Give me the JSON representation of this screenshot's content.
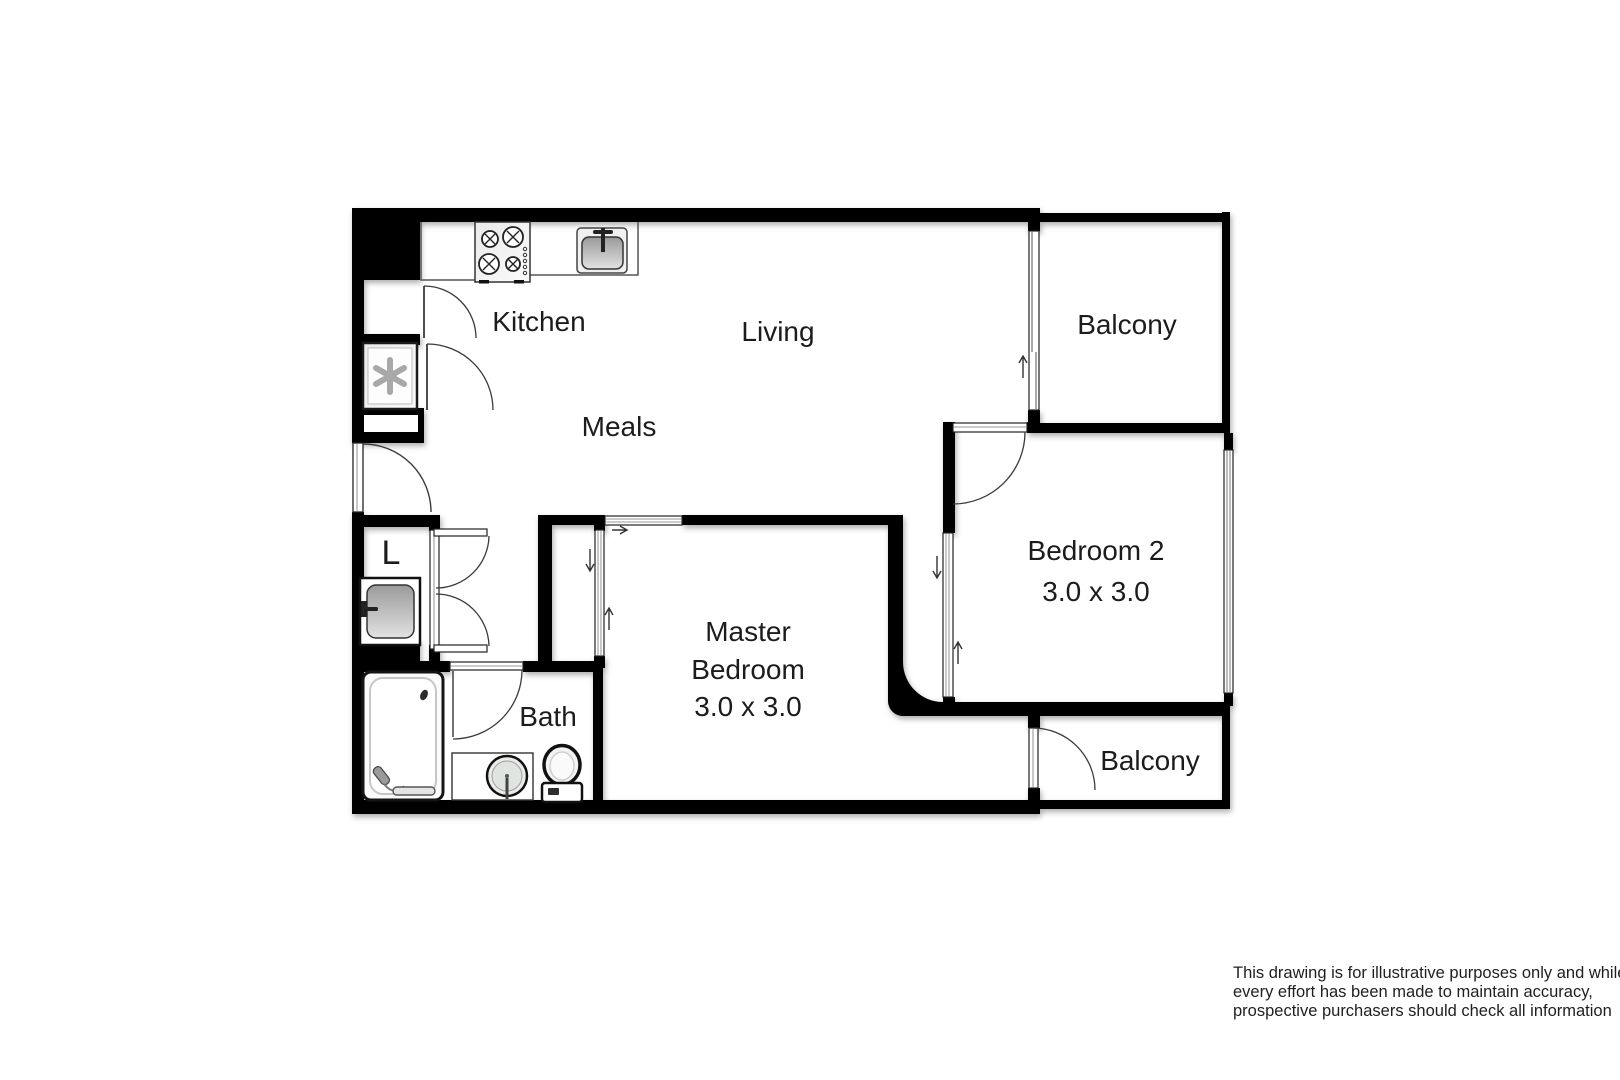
{
  "floorplan": {
    "labels": {
      "kitchen": "Kitchen",
      "living": "Living",
      "meals": "Meals",
      "balcony_top": "Balcony",
      "balcony_bottom": "Balcony",
      "bedroom2_name": "Bedroom 2",
      "bedroom2_dims": "3.0 x 3.0",
      "master_line1": "Master",
      "master_line2": "Bedroom",
      "master_dims": "3.0 x 3.0",
      "bath": "Bath",
      "laundry": "L"
    },
    "fixtures": [
      "cooktop",
      "kitchen-sink",
      "hot-water-unit",
      "laundry-trough",
      "bathtub",
      "vanity-basin",
      "toilet"
    ],
    "colors": {
      "wall": "#000000",
      "door_line": "#3a3a3a",
      "background": "#ffffff"
    }
  },
  "disclaimer": {
    "line1": "This drawing is for illustrative purposes only and while",
    "line2": "every effort has been made to maintain accuracy,",
    "line3": "prospective purchasers should check all information"
  }
}
